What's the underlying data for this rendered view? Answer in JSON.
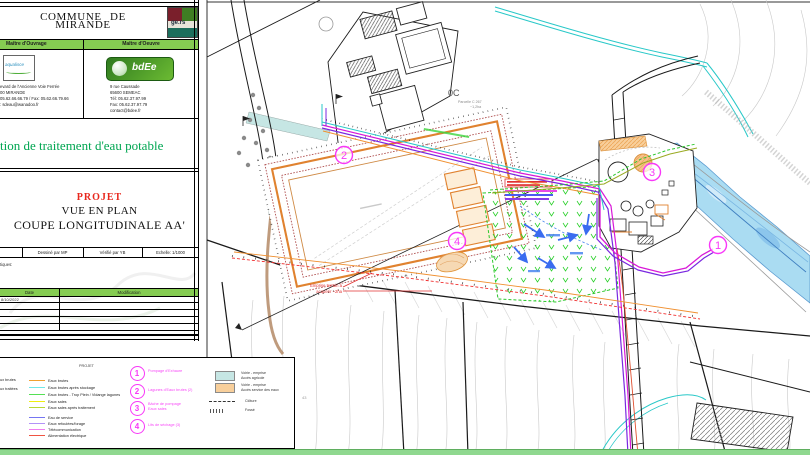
{
  "cartouche": {
    "commune_line1": "COMMUNE  DE",
    "commune_line2": "MIRANDE",
    "moa_header": "Maître d'Ouvrage",
    "moe_header": "Maître d'Oeuvre",
    "moa_logo_text": "aqualisce",
    "moa_address": [
      "evard de l'Ancienne Voie Ferrée",
      "00 MIRANDE",
      "05.62.66.66.79 / Fax: 05.62.66.79.66",
      ": sdeau@wanadoo.fr"
    ],
    "moe_logo_text": "bdEe",
    "moe_address": [
      "9 rue Caussade",
      "65600 SEMEAC",
      "Tél: 05.62.37.97.99",
      "Fax: 05.62.37.97.79",
      "contact@bdee.fr"
    ],
    "main_title": "tion de traitement d'eau potable",
    "project_label": "PROJET",
    "view_label": "VUE EN PLAN",
    "section_label": "COUPE LONGITUDINALE AA'",
    "drawn_by": "Dessiné par MP",
    "checked_by": "Vérifié par YB",
    "scale_label": "Echelle: 1/1000",
    "notes_fragment": "tiques:",
    "table": {
      "date_header": "Date",
      "modification_header": "Modification",
      "first_row_date": "8/10/2022"
    }
  },
  "legend": {
    "project_header": "PROJET",
    "existing_items": [
      "aux brutes",
      "aux traitées"
    ],
    "lines": [
      {
        "label": "Eaux brutes",
        "color": "#f0a030"
      },
      {
        "label": "Eaux brutes après stockage",
        "color": "#70e8e8"
      },
      {
        "label": "Eaux brutes - Trop Plein / Vidange lagunes",
        "color": "#55e055"
      },
      {
        "label": "Eaux sales",
        "color": "#eeee10"
      },
      {
        "label": "Eaux sales après traitement",
        "color": "#b8d832"
      },
      {
        "label": "Eau de service",
        "color": "#7575f2"
      },
      {
        "label": "Eaux refoulées/forage",
        "color": "#b392f8"
      },
      {
        "label": "Télécommunication",
        "color": "#f07ef0"
      },
      {
        "label": "Alimentation électrique",
        "color": "#f05442"
      }
    ],
    "numbered_items": [
      {
        "num": "1",
        "label": "Pompage d'Exhaure"
      },
      {
        "num": "2",
        "label": "Lagunes d'Eaux brutes (2)"
      },
      {
        "num": "3",
        "label": "Bâche de pompage Eaux sales"
      },
      {
        "num": "4",
        "label": "Lits de séchage (3)"
      }
    ],
    "area_items": [
      {
        "line1": "Voirie - emprise",
        "line2": "Accès agricole",
        "color": "#c6e6e4"
      },
      {
        "line1": "Voirie - emprise",
        "line2": "Accès service des eaux",
        "color": "#f8cf9b"
      }
    ],
    "cloture_label": "Clôture",
    "fosse_label": "Fossé"
  },
  "plan": {
    "zone_label": "0C",
    "parcel_note_line1": "Parcelle C 267",
    "parcel_note_line2": "~1,2ha",
    "acquire_line1": "Emprise terrain à",
    "acquire_line2": "acquérir ~2ha",
    "contour_label": "43",
    "marker1": "1",
    "marker2": "2",
    "marker3": "3",
    "marker4": "4"
  },
  "colors": {
    "header_green": "#85cc52",
    "title_green": "#00a651",
    "projet_red": "#e8281e",
    "marker_magenta": "#f838f8",
    "bottom_strip_green": "#8fd88f",
    "river_blue": "#aadcf2"
  }
}
